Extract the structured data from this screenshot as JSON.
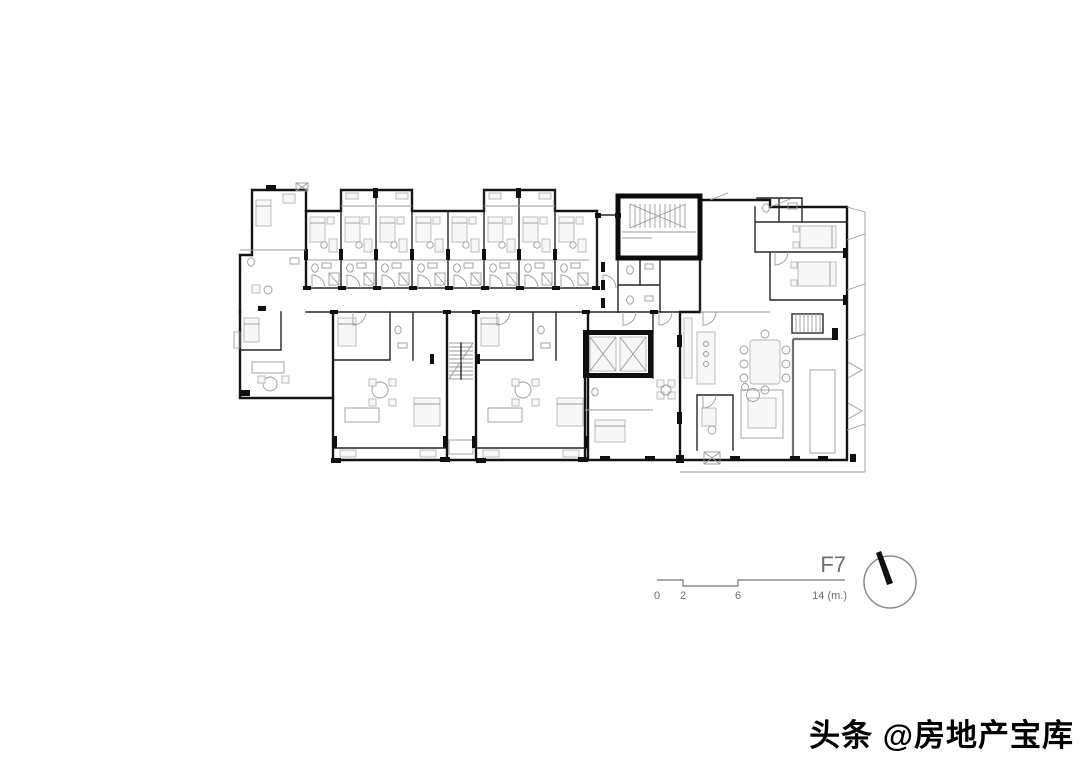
{
  "figure": {
    "floor_label": "F7",
    "scale_bar": {
      "ticks": [
        "0",
        "2",
        "6",
        "14 (m.)"
      ]
    }
  },
  "watermark": {
    "text": "头条 @房地产宝库"
  },
  "colors": {
    "bg": "#ffffff",
    "wall": "#141414",
    "line": "#9b9b9b",
    "furniture": "#b6b6b6",
    "label": "#6e6e6e"
  }
}
